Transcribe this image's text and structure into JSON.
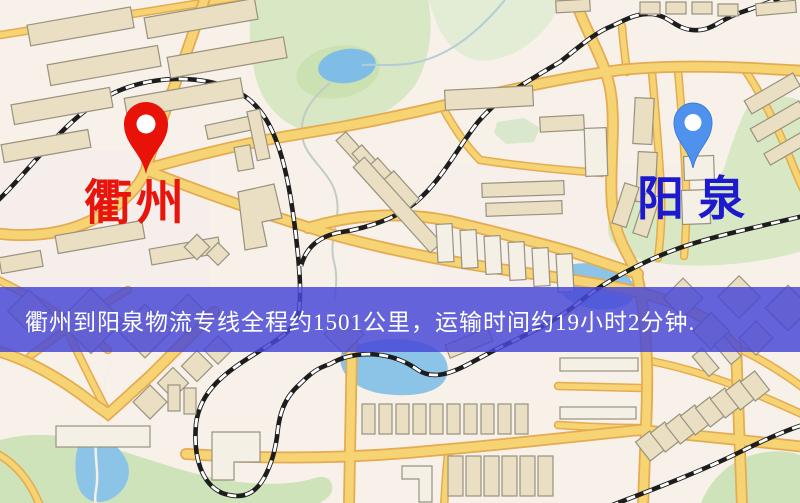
{
  "route_map": {
    "origin": {
      "label": "衢州",
      "pin_color": "#e91208",
      "label_color": "#e8150d"
    },
    "destination": {
      "label": "阳泉",
      "pin_color": "#4f92ee",
      "label_color": "#1c1ace"
    },
    "banner": {
      "text": "衢州到阳泉物流专线全程约1501公里，运输时间约19小时2分钟.",
      "background_color": "#4848d6",
      "text_color": "#ffffff"
    },
    "route": {
      "distance_km": 1501,
      "duration_hours": 19,
      "duration_minutes": 2
    },
    "icons": {
      "origin_pin": "map-pin-icon",
      "destination_pin": "map-pin-icon"
    }
  }
}
